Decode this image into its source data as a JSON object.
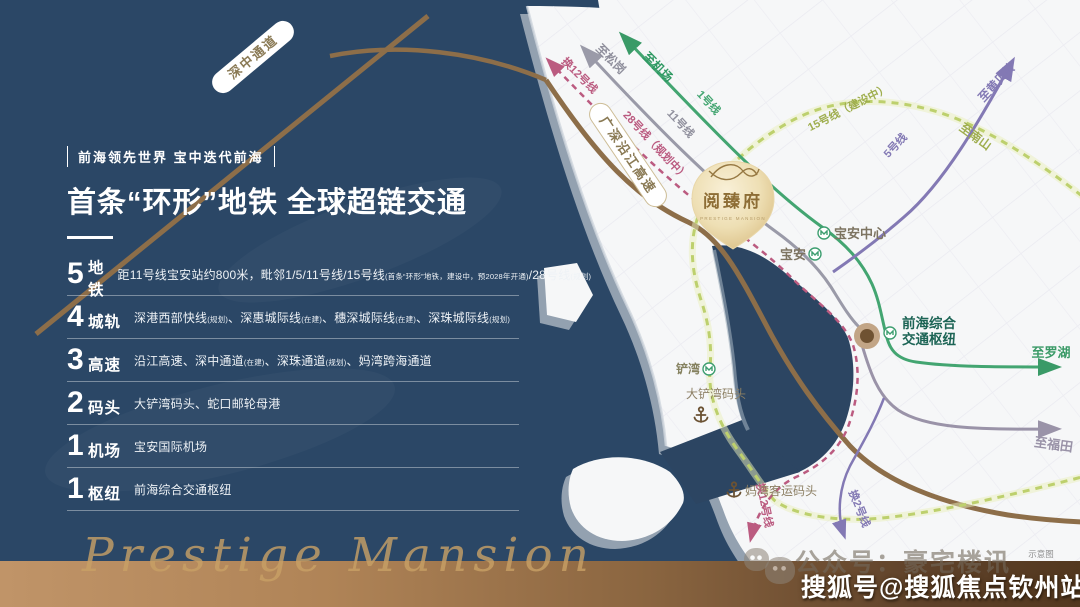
{
  "panel": {
    "tagline": "前海领先世界 宝中迭代前海",
    "title": "首条“环形”地铁 全球超链交通",
    "items": [
      {
        "num": "5",
        "unit": "地铁",
        "seg": [
          "距11号线宝安站约800米，毗邻1/5/11号线/15号线",
          "(首条“环形”地铁，建设中，预2028年开通)",
          "/28号线",
          "(规划)"
        ]
      },
      {
        "num": "4",
        "unit": "城轨",
        "seg": [
          "深港西部快线",
          "(规划)",
          "、深惠城际线",
          "(在建)",
          "、穗深城际线",
          "(在建)",
          "、深珠城际线",
          "(规划)"
        ]
      },
      {
        "num": "3",
        "unit": "高速",
        "seg": [
          "沿江高速、深中通道",
          "(在建)",
          "、深珠通道",
          "(规划)",
          "、妈湾跨海通道"
        ]
      },
      {
        "num": "2",
        "unit": "码头",
        "seg": [
          "大铲湾码头、蛇口邮轮母港"
        ]
      },
      {
        "num": "1",
        "unit": "机场",
        "seg": [
          "宝安国际机场"
        ]
      },
      {
        "num": "1",
        "unit": "枢纽",
        "seg": [
          "前海综合交通枢纽"
        ]
      }
    ]
  },
  "map": {
    "roads": {
      "shenzhong": "深中通道",
      "yanjiang": "广深沿江高速"
    },
    "lines": {
      "l1": "1号线",
      "l11": "11号线",
      "l28": "28号线（规划中）",
      "l5": "5号线",
      "l15": "15号线（建设中）"
    },
    "directions": {
      "to_airport": "至机场",
      "to_songgang": "至松岗",
      "x12_top": "换12号线",
      "to_huangbeiling": "至黄贝岭",
      "to_nanshan": "至南山",
      "to_luohu": "至罗湖",
      "to_futian": "至福田",
      "x2": "换2号线",
      "x12_bottom": "换12号线"
    },
    "stations": {
      "baoan_center": "宝安中心",
      "baoan": "宝安",
      "chanwan": "铲湾",
      "hub_line1": "前海综合",
      "hub_line2": "交通枢纽"
    },
    "ports": {
      "dachanwan": "大铲湾码头",
      "mawan": "妈湾客运码头"
    },
    "note": "示意图"
  },
  "logo": {
    "name": "阅臻府",
    "en": "PRESTIGE MANSION"
  },
  "watermarks": {
    "wechat": "公众号：豪宅楼讯",
    "sohu": "搜狐号@搜狐焦点钦州站",
    "script": "Prestige Mansion"
  },
  "colors": {
    "ocean": "#2b4766",
    "land": "#f6f7f8",
    "road": "#8d6e49",
    "line1": "#43a571",
    "line11": "#9a9aa8",
    "line28": "#bb5b80",
    "line5": "#8379b4",
    "line15": "#bdd06d",
    "hub_text": "#1c6455",
    "gold": "#c9a166",
    "band_dark": "#53381f",
    "pin_fill": "#eedfb4",
    "pin_text": "#8d6d35"
  }
}
